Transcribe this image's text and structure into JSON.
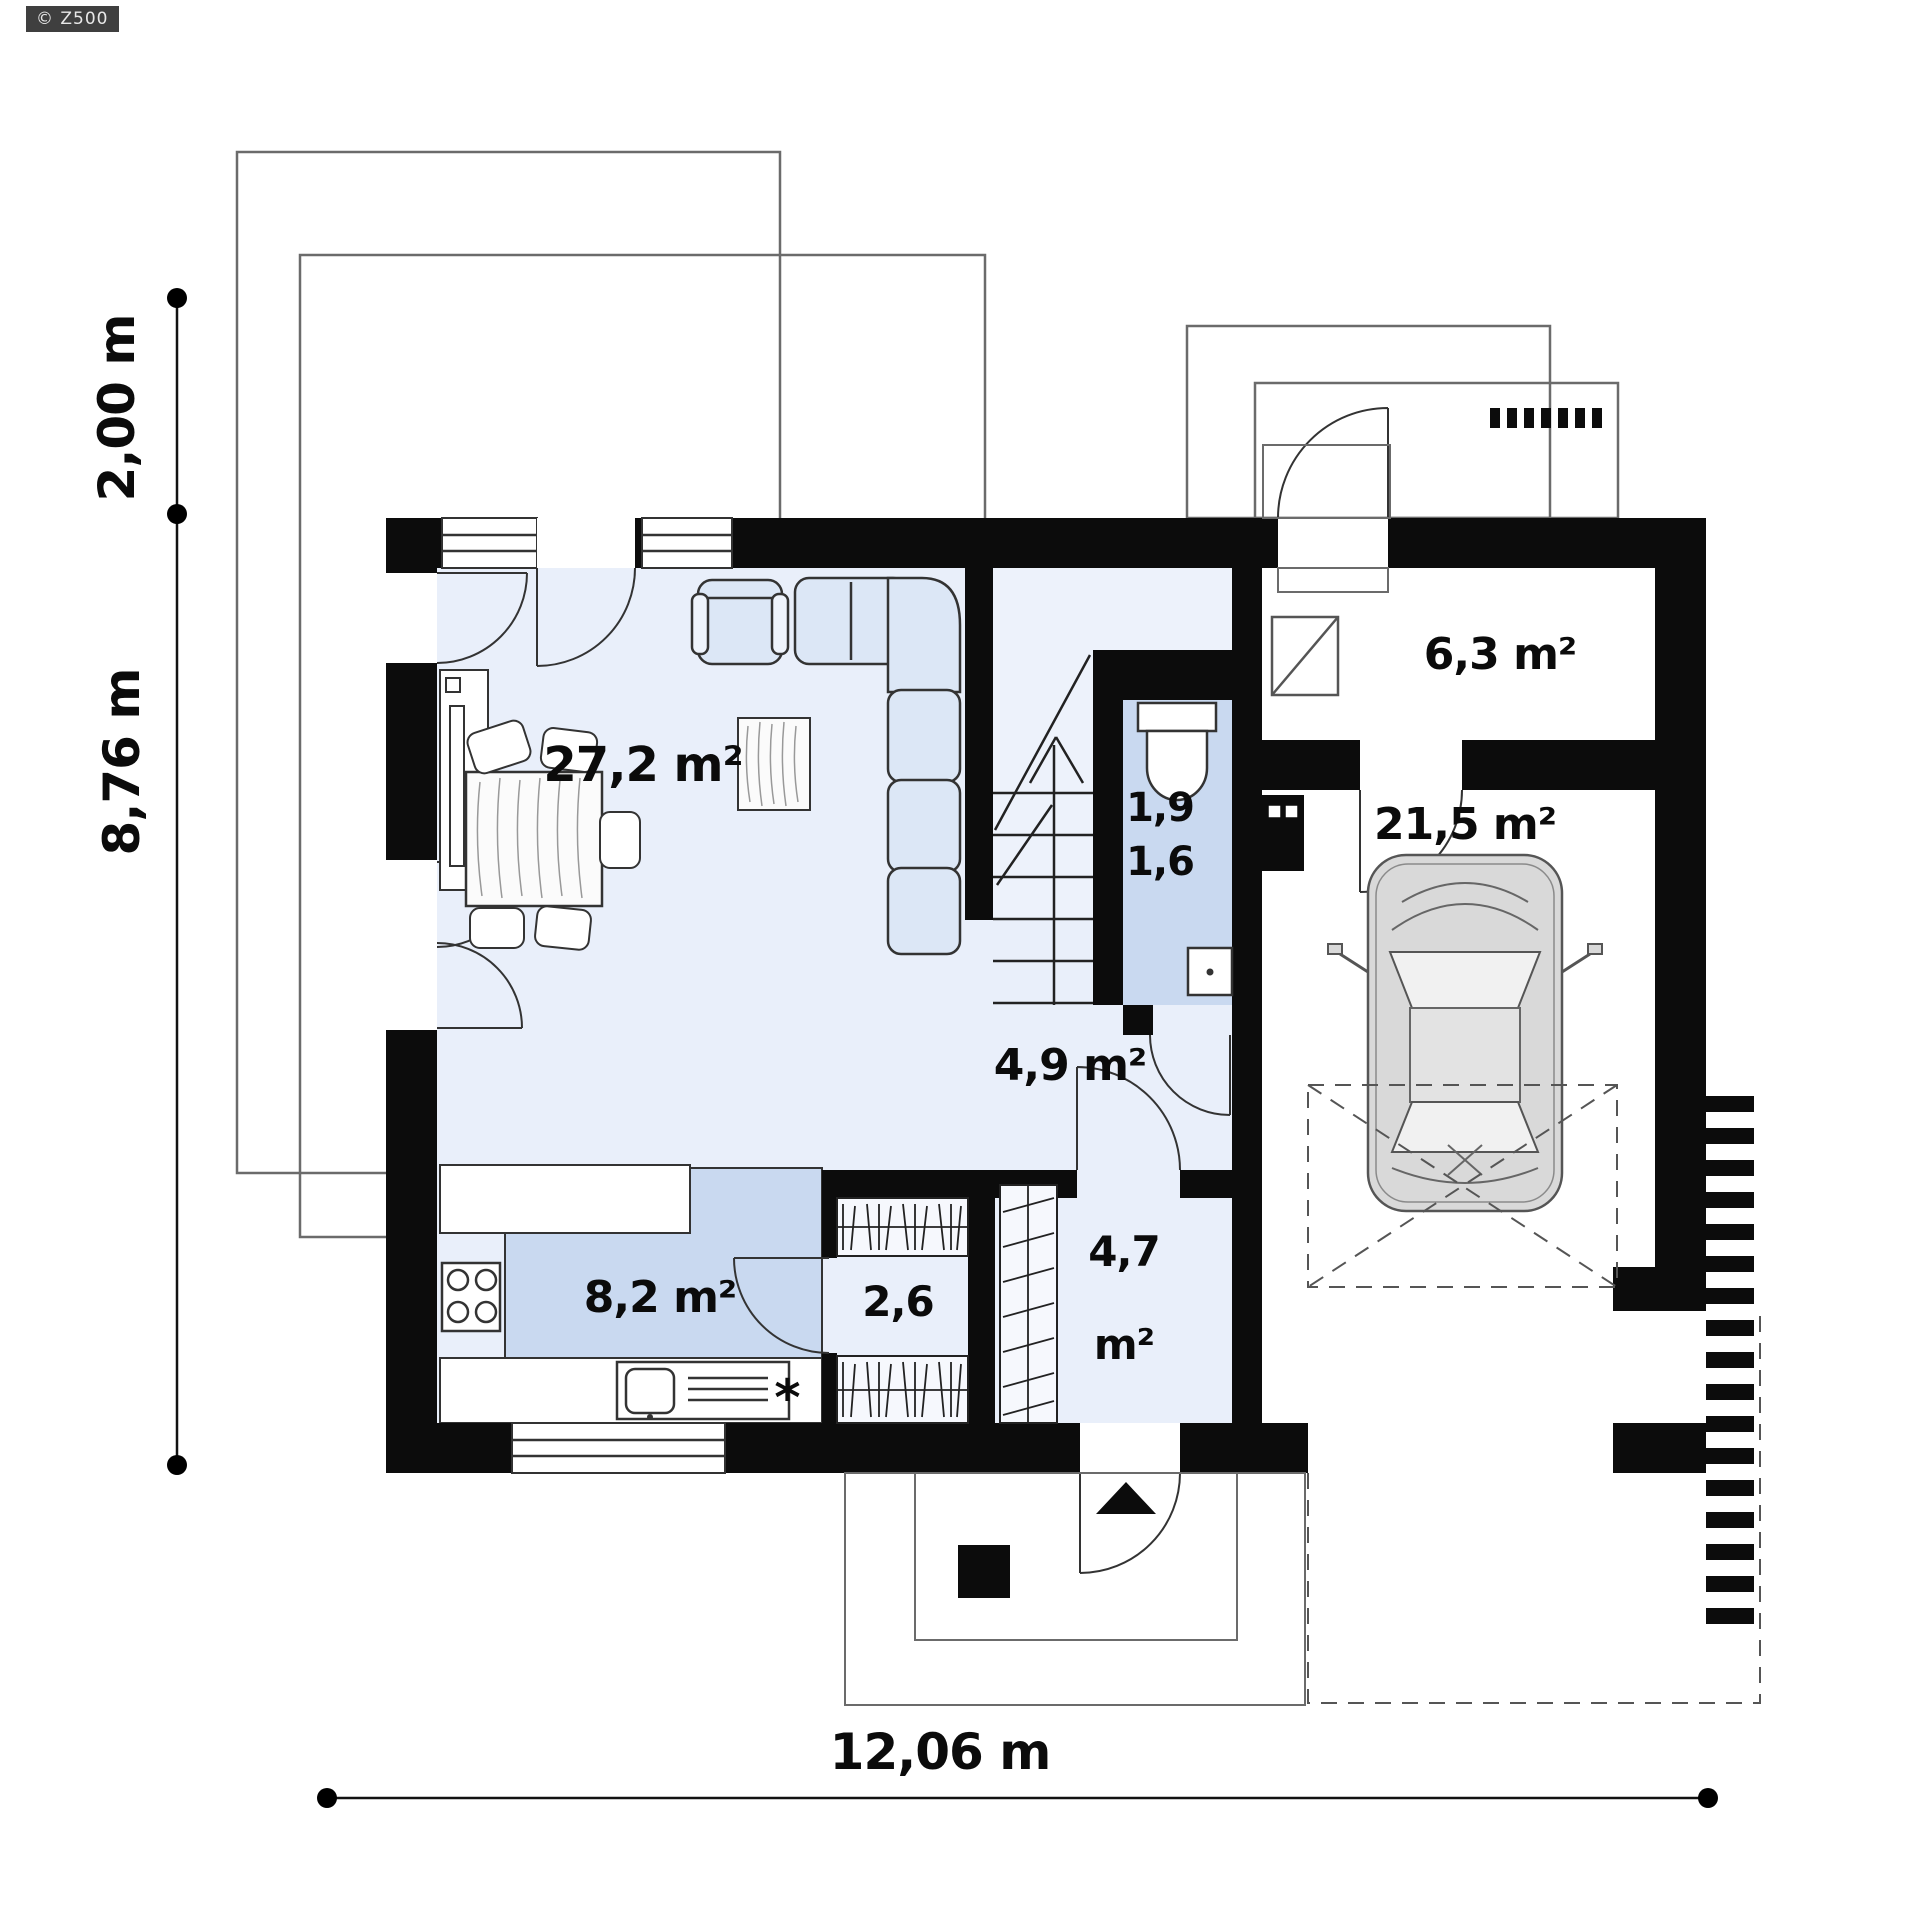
{
  "badge": {
    "label": "© Z500"
  },
  "dimensions": {
    "height_offset": "2,00 m",
    "height_total": "8,76 m",
    "width_total": "12,06 m"
  },
  "rooms": {
    "living": "27,2 m²",
    "kitchen": "8,2 m²",
    "pantry": "2,6",
    "wc_upper": "1,9",
    "wc_lower": "1,6",
    "hall": "4,9 m²",
    "entry_line1": "4,7",
    "entry_line2": "m²",
    "vestibule": "6,3 m²",
    "garage": "21,5 m²"
  },
  "symbols": {
    "kitchen_note": "*"
  },
  "colors": {
    "wall": "#0c0c0c",
    "floor": "#e9effa",
    "floor_accent": "#c9d9f0",
    "furniture": "#dce7f6",
    "outline_thin": "#6b6b6b"
  }
}
